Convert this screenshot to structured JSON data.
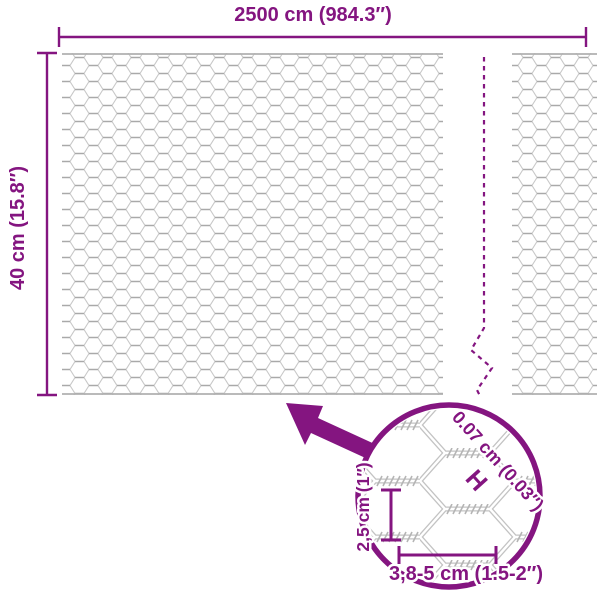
{
  "colors": {
    "accent": "#841580",
    "mesh_light": "#c8c8c8",
    "mesh_dark": "#a9a9a9"
  },
  "overall_dimensions": {
    "width_label": "2500 cm (984.3″)",
    "height_label": "40 cm (15.8″)"
  },
  "detail_view": {
    "wire_diameter_label": "0.07 cm (0.03″)",
    "wire_diameter_marker": "H",
    "mesh_cell_height_label": "2,5 cm (1″)",
    "mesh_cell_width_label": "3,8-5 cm (1.5-2″)"
  }
}
